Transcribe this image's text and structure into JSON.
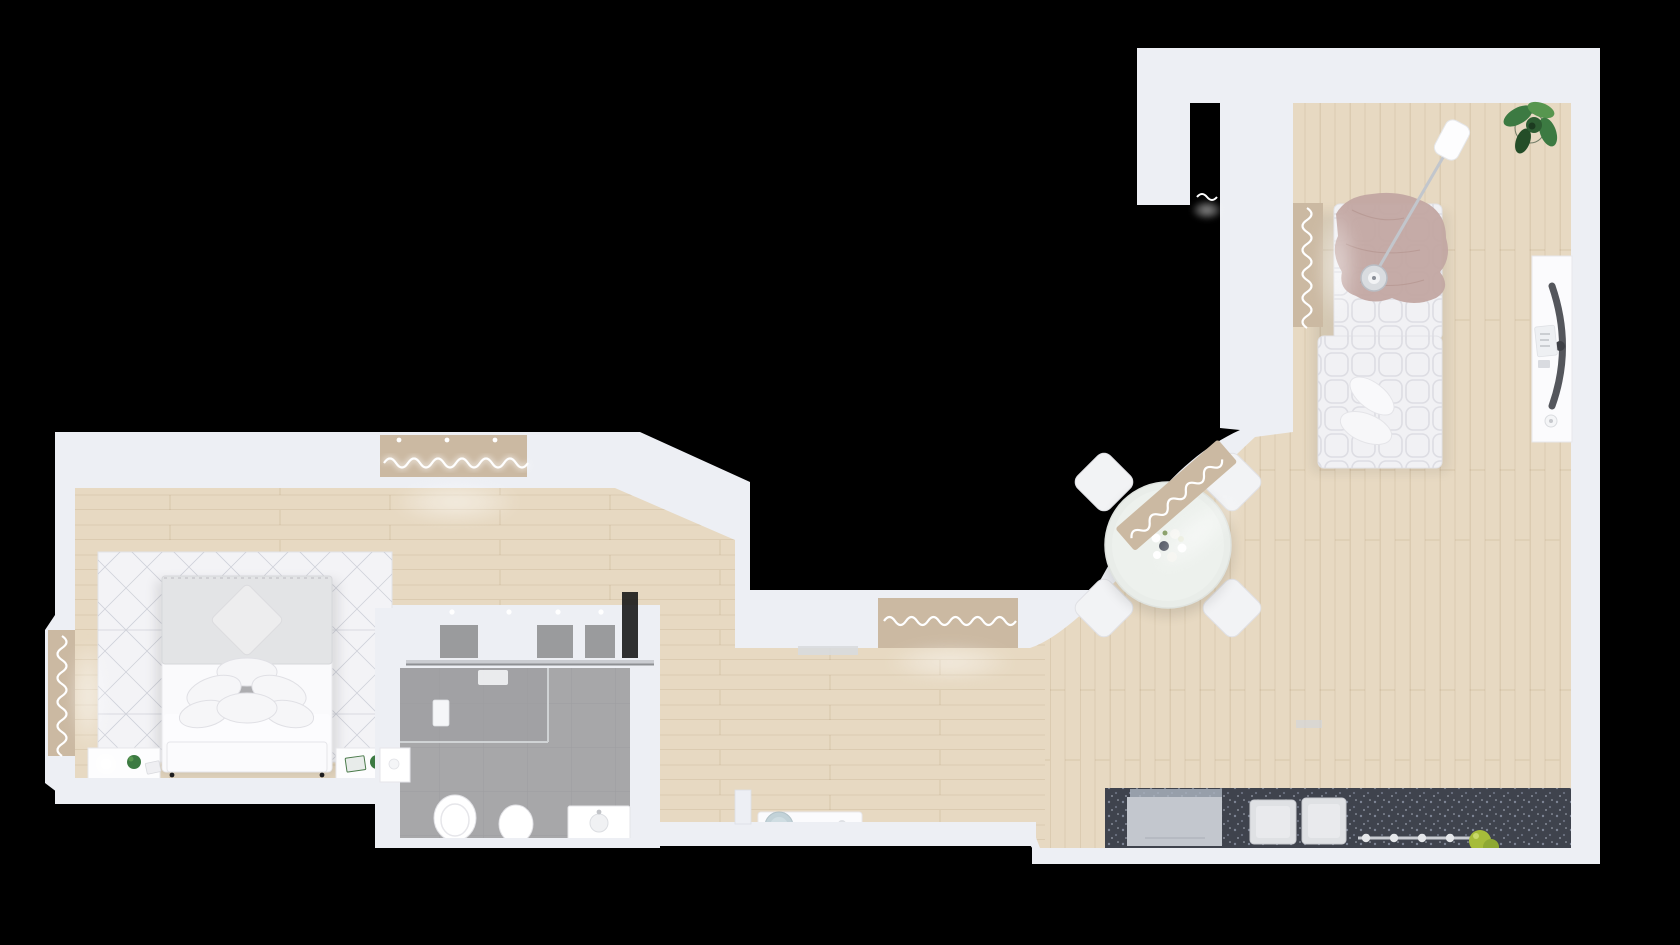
{
  "scene": {
    "kind": "apartment-floor-plan-3d-top-view",
    "background": "#000000"
  },
  "palette": {
    "background": "#000000",
    "wall": "#edeff4",
    "wall_shadow": "#d9dce4",
    "floor_wood": "#e7d9c2",
    "floor_wood_hall": "#e4d5bc",
    "bathroom_tile": "#a7a7a9",
    "bathroom_tile_dark": "#9d9da0",
    "rug": "#f3f3f6",
    "rug_line": "#c3c5cf",
    "counter_granite": "#3f434d",
    "cabinet_gray": "#c3c7ce",
    "closet_gray": "#9a9b9d",
    "furniture_white": "#f7f7f9",
    "bed_white": "#fafafc",
    "blanket_gray": "#e3e4e6",
    "blanket_pink": "#c2a6a2",
    "plant_green": "#3c7a42",
    "plant_green_dark": "#244d28",
    "apple_green": "#a6bc3a",
    "stool_blue": "#c2d2d8",
    "window_sill": "#cbb9a2",
    "curtain_white": "#ffffff",
    "monitor_dark": "#54565c",
    "sink_white": "#dfe1e4"
  },
  "rooms": [
    {
      "name": "living-room",
      "furniture": [
        "sectional-sofa",
        "throw-blanket",
        "sofa-pillows",
        "arc-floor-lamp",
        "potted-plant",
        "desk",
        "curved-monitor",
        "mouse"
      ]
    },
    {
      "name": "dining-area",
      "furniture": [
        "round-table",
        "chair",
        "chair",
        "chair",
        "chair",
        "centerpiece-flowers"
      ]
    },
    {
      "name": "kitchen",
      "furniture": [
        "granite-counter",
        "cabinet-module",
        "double-sink",
        "utensil-rail",
        "fruit-bowl-apples",
        "range-hood"
      ]
    },
    {
      "name": "bedroom",
      "furniture": [
        "double-bed",
        "pillow-stack",
        "diamond-pillow",
        "geometric-rug",
        "nightstand-left",
        "nightstand-right",
        "table-lamps",
        "small-plants"
      ]
    },
    {
      "name": "bathroom",
      "furniture": [
        "closet-row",
        "shower-glass",
        "shower-control",
        "toilet",
        "bidet",
        "vanity-sink",
        "side-cabinet"
      ]
    },
    {
      "name": "hallway-entry",
      "furniture": [
        "wall-stub",
        "entry-console",
        "round-stool",
        "doormat"
      ]
    }
  ],
  "windows": [
    {
      "location": "bedroom-top-wall"
    },
    {
      "location": "bedroom-left-wall"
    },
    {
      "location": "hallway-top-wall"
    },
    {
      "location": "dining-curved-wall"
    },
    {
      "location": "living-room-left-wall"
    },
    {
      "location": "living-room-top-gap"
    }
  ]
}
